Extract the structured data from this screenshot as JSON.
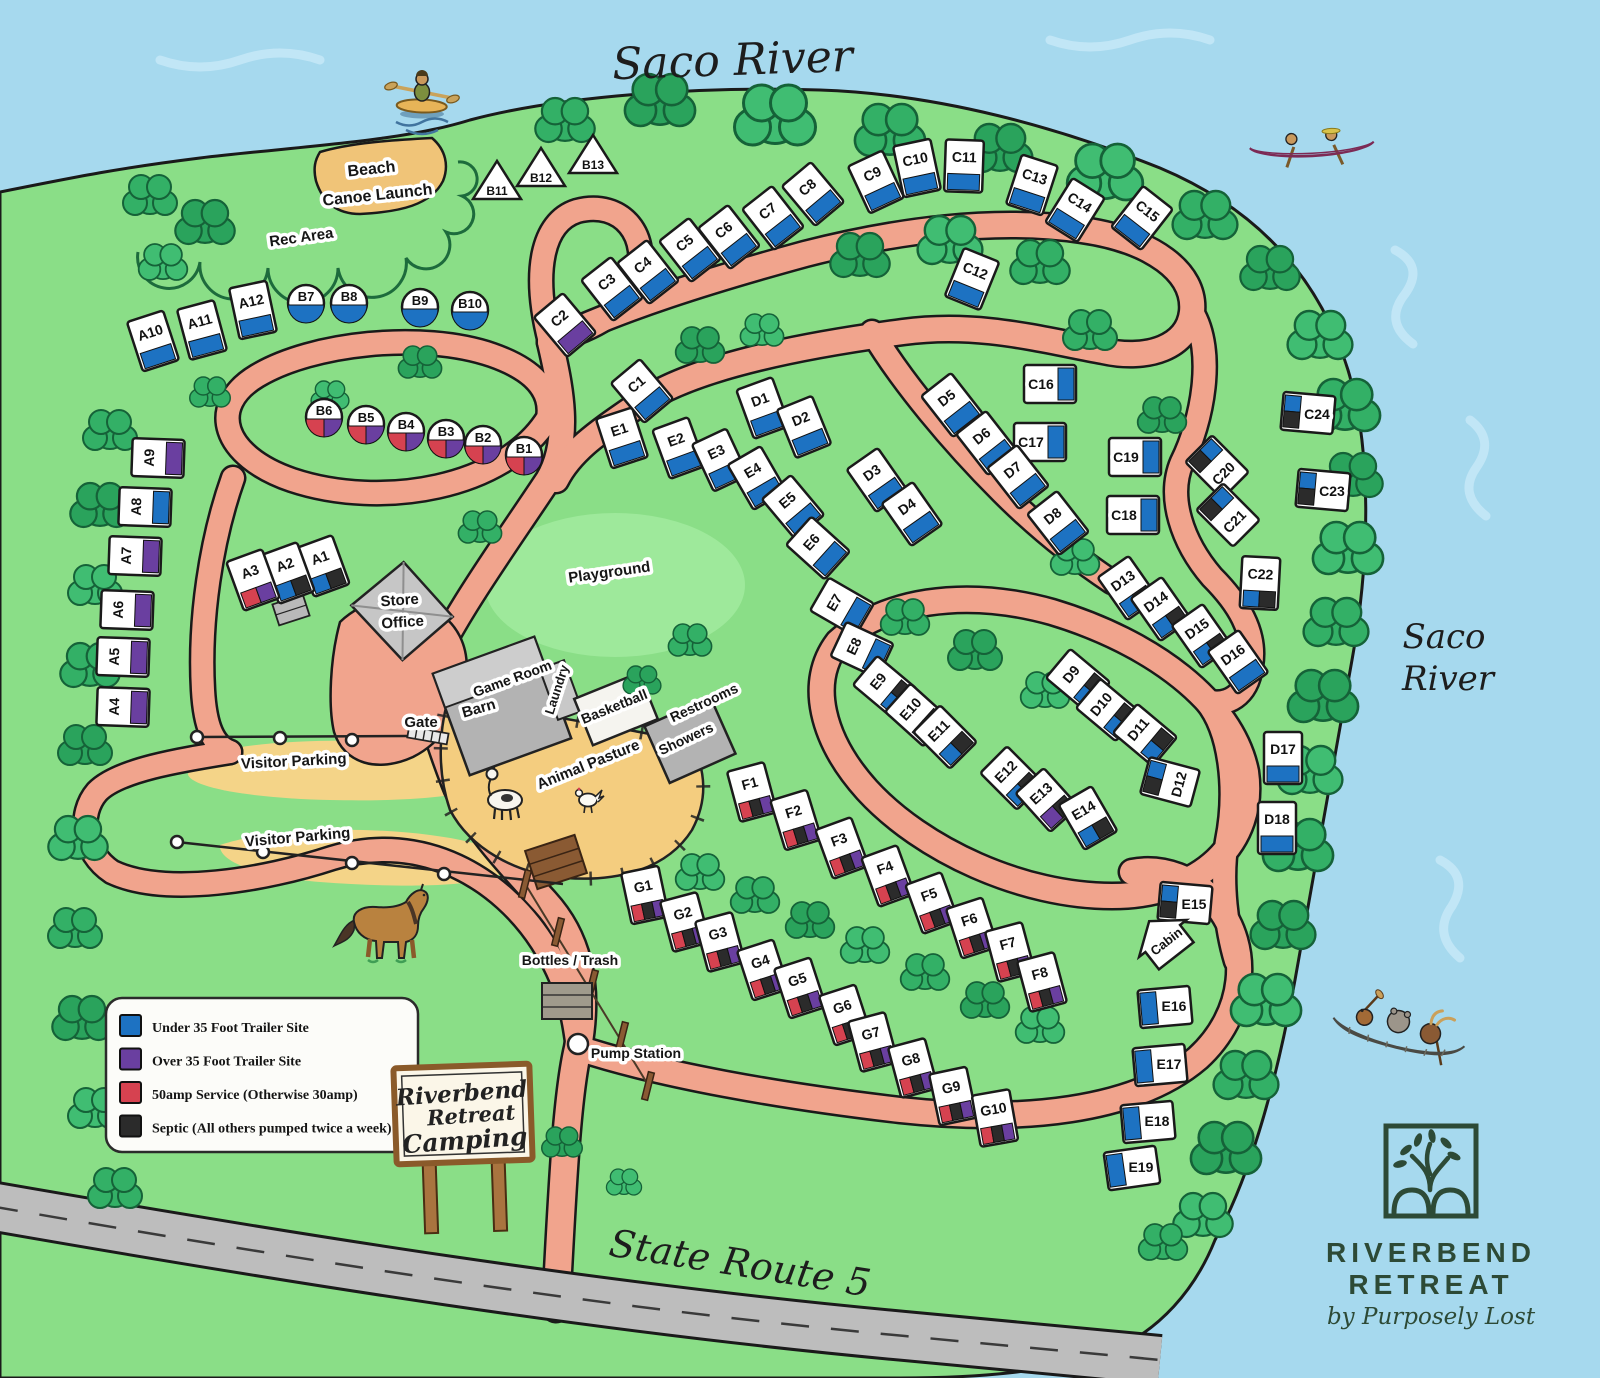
{
  "map_title": "Riverbend Retreat Camping Map",
  "river_label_top": "Saco River",
  "river_label_right_line1": "Saco",
  "river_label_right_line2": "River",
  "road_label": "State Route 5",
  "palette": {
    "water": "#a6d9ee",
    "land": "#8ade87",
    "road": "#f1a48d",
    "sand": "#f4cd7f",
    "tree": "#2fae62",
    "logo_green": "#2d4a36",
    "site_colors": {
      "blue": "#1d72c2",
      "purple": "#6a3fa0",
      "red": "#d64250",
      "black": "#2b2b2b"
    }
  },
  "legend": {
    "items": [
      {
        "color_key": "blue",
        "color": "#1d72c2",
        "label": "Under 35 Foot Trailer Site"
      },
      {
        "color_key": "purple",
        "color": "#6a3fa0",
        "label": "Over 35 Foot Trailer Site"
      },
      {
        "color_key": "red",
        "color": "#d64250",
        "label": "50amp Service (Otherwise 30amp)"
      },
      {
        "color_key": "black",
        "color": "#2b2b2b",
        "label": "Septic (All others pumped twice a week)"
      }
    ]
  },
  "sign": {
    "lines": [
      "Riverbend",
      "Retreat",
      "Camping"
    ]
  },
  "logo": {
    "line1": "RIVERBEND",
    "line2": "RETREAT",
    "tagline": "by Purposely Lost"
  },
  "labels": [
    {
      "text": "Saco River",
      "x": 733,
      "y": 75,
      "rot": -2,
      "size": 44,
      "style": "hand"
    },
    {
      "text": "Saco",
      "x": 1444,
      "y": 648,
      "rot": 0,
      "size": 34,
      "style": "hand"
    },
    {
      "text": "River",
      "x": 1448,
      "y": 690,
      "rot": 0,
      "size": 34,
      "style": "hand"
    },
    {
      "text": "State Route 5",
      "x": 738,
      "y": 1276,
      "rot": 9,
      "size": 38,
      "style": "hand"
    },
    {
      "text": "Beach",
      "x": 372,
      "y": 174,
      "rot": -6,
      "size": 16,
      "style": "chip"
    },
    {
      "text": "Canoe Launch",
      "x": 378,
      "y": 200,
      "rot": -6,
      "size": 16,
      "style": "chip"
    },
    {
      "text": "Rec Area",
      "x": 302,
      "y": 242,
      "rot": -8,
      "size": 15,
      "style": "chip"
    },
    {
      "text": "Playground",
      "x": 610,
      "y": 577,
      "rot": -8,
      "size": 15,
      "style": "chip"
    },
    {
      "text": "Store",
      "x": 400,
      "y": 605,
      "rot": -4,
      "size": 15,
      "style": "chip"
    },
    {
      "text": "Office",
      "x": 403,
      "y": 627,
      "rot": -4,
      "size": 15,
      "style": "chip"
    },
    {
      "text": "Game Room",
      "x": 514,
      "y": 683,
      "rot": -20,
      "size": 14,
      "style": "chip"
    },
    {
      "text": "Barn",
      "x": 480,
      "y": 713,
      "rot": -16,
      "size": 15,
      "style": "chip"
    },
    {
      "text": "Laundry",
      "x": 561,
      "y": 691,
      "rot": -72,
      "size": 13,
      "style": "chip"
    },
    {
      "text": "Basketball",
      "x": 616,
      "y": 711,
      "rot": -22,
      "size": 14,
      "style": "chip"
    },
    {
      "text": "Restrooms",
      "x": 706,
      "y": 707,
      "rot": -25,
      "size": 14,
      "style": "chip"
    },
    {
      "text": "Showers",
      "x": 688,
      "y": 743,
      "rot": -25,
      "size": 14,
      "style": "chip"
    },
    {
      "text": "Animal Pasture",
      "x": 590,
      "y": 769,
      "rot": -22,
      "size": 15,
      "style": "chip"
    },
    {
      "text": "Gate",
      "x": 421,
      "y": 727,
      "rot": 0,
      "size": 15,
      "style": "chip",
      "color": "#41368c"
    },
    {
      "text": "Visitor Parking",
      "x": 294,
      "y": 766,
      "rot": -3,
      "size": 15,
      "style": "chip"
    },
    {
      "text": "Visitor Parking",
      "x": 298,
      "y": 842,
      "rot": -5,
      "size": 15,
      "style": "chip"
    },
    {
      "text": "Bottles / Trash",
      "x": 570,
      "y": 965,
      "rot": 0,
      "size": 14,
      "style": "chip"
    },
    {
      "text": "Pump Station",
      "x": 636,
      "y": 1058,
      "rot": 0,
      "size": 14,
      "style": "chip"
    }
  ],
  "sites": [
    {
      "id": "A1",
      "x": 323,
      "y": 566,
      "rot": -20,
      "kind": "rv",
      "c": [
        "blue",
        "black"
      ]
    },
    {
      "id": "A2",
      "x": 288,
      "y": 573,
      "rot": -20,
      "kind": "rv",
      "c": [
        "blue",
        "black"
      ]
    },
    {
      "id": "A3",
      "x": 253,
      "y": 580,
      "rot": -20,
      "kind": "rv",
      "c": [
        "red",
        "purple"
      ]
    },
    {
      "id": "A4",
      "x": 123,
      "y": 707,
      "rot": -88,
      "kind": "rv",
      "c": [
        "purple"
      ]
    },
    {
      "id": "A5",
      "x": 123,
      "y": 657,
      "rot": -88,
      "kind": "rv",
      "c": [
        "purple"
      ]
    },
    {
      "id": "A6",
      "x": 127,
      "y": 610,
      "rot": -88,
      "kind": "rv",
      "c": [
        "purple"
      ]
    },
    {
      "id": "A7",
      "x": 135,
      "y": 556,
      "rot": -88,
      "kind": "rv",
      "c": [
        "purple"
      ]
    },
    {
      "id": "A8",
      "x": 145,
      "y": 507,
      "rot": -88,
      "kind": "rv",
      "c": [
        "blue"
      ]
    },
    {
      "id": "A9",
      "x": 158,
      "y": 458,
      "rot": -88,
      "kind": "rv",
      "c": [
        "purple"
      ]
    },
    {
      "id": "A10",
      "x": 153,
      "y": 341,
      "rot": -18,
      "kind": "rv",
      "c": [
        "blue"
      ]
    },
    {
      "id": "A11",
      "x": 202,
      "y": 330,
      "rot": -15,
      "kind": "rv",
      "c": [
        "blue"
      ]
    },
    {
      "id": "A12",
      "x": 253,
      "y": 310,
      "rot": -12,
      "kind": "rv",
      "c": [
        "blue"
      ]
    },
    {
      "id": "B1",
      "x": 524,
      "y": 455,
      "kind": "circle",
      "c": [
        "red",
        "purple"
      ]
    },
    {
      "id": "B2",
      "x": 483,
      "y": 444,
      "kind": "circle",
      "c": [
        "red",
        "purple"
      ]
    },
    {
      "id": "B3",
      "x": 446,
      "y": 438,
      "kind": "circle",
      "c": [
        "red",
        "purple"
      ]
    },
    {
      "id": "B4",
      "x": 406,
      "y": 431,
      "kind": "circle",
      "c": [
        "red",
        "purple"
      ]
    },
    {
      "id": "B5",
      "x": 366,
      "y": 424,
      "kind": "circle",
      "c": [
        "red",
        "purple"
      ]
    },
    {
      "id": "B6",
      "x": 324,
      "y": 417,
      "kind": "circle",
      "c": [
        "red",
        "purple"
      ]
    },
    {
      "id": "B7",
      "x": 306,
      "y": 303,
      "kind": "circle",
      "c": [
        "blue"
      ]
    },
    {
      "id": "B8",
      "x": 349,
      "y": 303,
      "kind": "circle",
      "c": [
        "blue"
      ]
    },
    {
      "id": "B9",
      "x": 420,
      "y": 307,
      "kind": "circle",
      "c": [
        "blue"
      ]
    },
    {
      "id": "B10",
      "x": 470,
      "y": 310,
      "kind": "circle",
      "c": [
        "blue"
      ]
    },
    {
      "id": "B11",
      "x": 497,
      "y": 183,
      "kind": "tent"
    },
    {
      "id": "B12",
      "x": 541,
      "y": 170,
      "kind": "tent"
    },
    {
      "id": "B13",
      "x": 593,
      "y": 157,
      "kind": "tent"
    },
    {
      "id": "C1",
      "x": 642,
      "y": 391,
      "rot": -40,
      "kind": "rv",
      "c": [
        "blue"
      ]
    },
    {
      "id": "C2",
      "x": 565,
      "y": 325,
      "rot": -40,
      "kind": "rv",
      "c": [
        "purple"
      ]
    },
    {
      "id": "C3",
      "x": 612,
      "y": 289,
      "rot": -38,
      "kind": "rv",
      "c": [
        "blue"
      ]
    },
    {
      "id": "C4",
      "x": 648,
      "y": 272,
      "rot": -38,
      "kind": "rv",
      "c": [
        "blue"
      ]
    },
    {
      "id": "C5",
      "x": 690,
      "y": 250,
      "rot": -38,
      "kind": "rv",
      "c": [
        "blue"
      ]
    },
    {
      "id": "C6",
      "x": 729,
      "y": 237,
      "rot": -38,
      "kind": "rv",
      "c": [
        "blue"
      ]
    },
    {
      "id": "C7",
      "x": 773,
      "y": 218,
      "rot": -38,
      "kind": "rv",
      "c": [
        "blue"
      ]
    },
    {
      "id": "C8",
      "x": 813,
      "y": 194,
      "rot": -40,
      "kind": "rv",
      "c": [
        "blue"
      ]
    },
    {
      "id": "C9",
      "x": 876,
      "y": 182,
      "rot": -25,
      "kind": "rv",
      "c": [
        "blue"
      ]
    },
    {
      "id": "C10",
      "x": 917,
      "y": 168,
      "rot": -12,
      "kind": "rv",
      "c": [
        "blue"
      ]
    },
    {
      "id": "C11",
      "x": 964,
      "y": 166,
      "rot": 2,
      "kind": "rv",
      "c": [
        "blue"
      ]
    },
    {
      "id": "C12",
      "x": 972,
      "y": 279,
      "rot": 22,
      "kind": "rv",
      "c": [
        "blue"
      ]
    },
    {
      "id": "C13",
      "x": 1032,
      "y": 185,
      "rot": 18,
      "kind": "rv",
      "c": [
        "blue"
      ]
    },
    {
      "id": "C14",
      "x": 1075,
      "y": 210,
      "rot": 32,
      "kind": "rv",
      "c": [
        "blue"
      ]
    },
    {
      "id": "C15",
      "x": 1142,
      "y": 218,
      "rot": 38,
      "kind": "rv",
      "c": [
        "blue"
      ]
    },
    {
      "id": "C16",
      "x": 1050,
      "y": 384,
      "rot": -90,
      "lh": true,
      "kind": "rv",
      "c": [
        "blue"
      ]
    },
    {
      "id": "C17",
      "x": 1040,
      "y": 442,
      "rot": -90,
      "lh": true,
      "kind": "rv",
      "c": [
        "blue"
      ]
    },
    {
      "id": "C18",
      "x": 1133,
      "y": 515,
      "rot": -90,
      "lh": true,
      "kind": "rv",
      "c": [
        "blue"
      ]
    },
    {
      "id": "C19",
      "x": 1135,
      "y": 457,
      "rot": -90,
      "lh": true,
      "kind": "rv",
      "c": [
        "blue"
      ]
    },
    {
      "id": "C20",
      "x": 1217,
      "y": 467,
      "rot": 135,
      "kind": "rv",
      "c": [
        "blue",
        "black"
      ]
    },
    {
      "id": "C21",
      "x": 1228,
      "y": 515,
      "rot": 135,
      "kind": "rv",
      "c": [
        "blue",
        "black"
      ]
    },
    {
      "id": "C22",
      "x": 1260,
      "y": 583,
      "rot": 3,
      "kind": "rv",
      "c": [
        "blue",
        "black"
      ]
    },
    {
      "id": "C23",
      "x": 1323,
      "y": 490,
      "rot": 95,
      "lh": true,
      "kind": "rv",
      "c": [
        "blue",
        "black"
      ]
    },
    {
      "id": "C24",
      "x": 1308,
      "y": 413,
      "rot": 95,
      "lh": true,
      "kind": "rv",
      "c": [
        "blue",
        "black"
      ]
    },
    {
      "id": "D1",
      "x": 763,
      "y": 408,
      "rot": -20,
      "kind": "rv",
      "c": [
        "blue"
      ]
    },
    {
      "id": "D2",
      "x": 804,
      "y": 427,
      "rot": -22,
      "kind": "rv",
      "c": [
        "blue"
      ]
    },
    {
      "id": "D3",
      "x": 877,
      "y": 480,
      "rot": -35,
      "kind": "rv",
      "c": [
        "blue"
      ]
    },
    {
      "id": "D4",
      "x": 912,
      "y": 514,
      "rot": -35,
      "kind": "rv",
      "c": [
        "blue"
      ]
    },
    {
      "id": "D5",
      "x": 952,
      "y": 405,
      "rot": -38,
      "kind": "rv",
      "c": [
        "blue"
      ]
    },
    {
      "id": "D6",
      "x": 987,
      "y": 443,
      "rot": -38,
      "kind": "rv",
      "c": [
        "blue"
      ]
    },
    {
      "id": "D7",
      "x": 1018,
      "y": 477,
      "rot": -38,
      "kind": "rv",
      "c": [
        "blue"
      ]
    },
    {
      "id": "D8",
      "x": 1058,
      "y": 523,
      "rot": -38,
      "kind": "rv",
      "c": [
        "blue"
      ]
    },
    {
      "id": "D9",
      "x": 1078,
      "y": 680,
      "rot": -50,
      "kind": "rv",
      "c": [
        "blue",
        "black"
      ]
    },
    {
      "id": "D10",
      "x": 1108,
      "y": 710,
      "rot": -50,
      "kind": "rv",
      "c": [
        "blue",
        "black"
      ]
    },
    {
      "id": "D11",
      "x": 1145,
      "y": 735,
      "rot": -50,
      "kind": "rv",
      "c": [
        "blue",
        "black"
      ]
    },
    {
      "id": "D12",
      "x": 1170,
      "y": 782,
      "rot": 105,
      "kind": "rv",
      "c": [
        "blue",
        "black"
      ]
    },
    {
      "id": "D13",
      "x": 1128,
      "y": 588,
      "rot": -35,
      "kind": "rv",
      "c": [
        "blue",
        "black"
      ]
    },
    {
      "id": "D14",
      "x": 1161,
      "y": 609,
      "rot": -35,
      "kind": "rv",
      "c": [
        "blue",
        "black"
      ]
    },
    {
      "id": "D15",
      "x": 1202,
      "y": 636,
      "rot": -35,
      "kind": "rv",
      "c": [
        "blue",
        "black"
      ]
    },
    {
      "id": "D16",
      "x": 1238,
      "y": 662,
      "rot": -35,
      "kind": "rv",
      "c": [
        "blue"
      ]
    },
    {
      "id": "D17",
      "x": 1283,
      "y": 758,
      "rot": 0,
      "kind": "rv",
      "c": [
        "blue"
      ]
    },
    {
      "id": "D18",
      "x": 1277,
      "y": 828,
      "rot": 0,
      "kind": "rv",
      "c": [
        "blue"
      ]
    },
    {
      "id": "E1",
      "x": 622,
      "y": 438,
      "rot": -18,
      "kind": "rv",
      "c": [
        "blue"
      ]
    },
    {
      "id": "E2",
      "x": 679,
      "y": 448,
      "rot": -20,
      "kind": "rv",
      "c": [
        "blue"
      ]
    },
    {
      "id": "E3",
      "x": 720,
      "y": 460,
      "rot": -25,
      "kind": "rv",
      "c": [
        "blue"
      ]
    },
    {
      "id": "E4",
      "x": 757,
      "y": 478,
      "rot": -30,
      "kind": "rv",
      "c": [
        "blue"
      ]
    },
    {
      "id": "E5",
      "x": 793,
      "y": 507,
      "rot": -40,
      "kind": "rv",
      "c": [
        "blue"
      ]
    },
    {
      "id": "E6",
      "x": 818,
      "y": 548,
      "rot": -48,
      "kind": "rv",
      "c": [
        "blue"
      ]
    },
    {
      "id": "E7",
      "x": 842,
      "y": 607,
      "rot": -60,
      "kind": "rv",
      "c": [
        "blue"
      ]
    },
    {
      "id": "E8",
      "x": 862,
      "y": 650,
      "rot": -65,
      "kind": "rv",
      "c": [
        "blue"
      ]
    },
    {
      "id": "E9",
      "x": 885,
      "y": 687,
      "rot": -50,
      "kind": "rv",
      "c": [
        "blue",
        "black"
      ]
    },
    {
      "id": "E10",
      "x": 917,
      "y": 715,
      "rot": -48,
      "kind": "rv",
      "c": [
        "blue",
        "black"
      ]
    },
    {
      "id": "E11",
      "x": 945,
      "y": 737,
      "rot": -45,
      "kind": "rv",
      "c": [
        "blue",
        "black"
      ]
    },
    {
      "id": "E12",
      "x": 1012,
      "y": 778,
      "rot": -45,
      "kind": "rv",
      "c": [
        "blue",
        "black"
      ]
    },
    {
      "id": "E13",
      "x": 1047,
      "y": 800,
      "rot": -42,
      "kind": "rv",
      "c": [
        "purple",
        "black"
      ]
    },
    {
      "id": "E14",
      "x": 1088,
      "y": 818,
      "rot": -30,
      "kind": "rv",
      "c": [
        "blue",
        "black"
      ]
    },
    {
      "id": "E15",
      "x": 1185,
      "y": 903,
      "rot": 95,
      "lh": true,
      "kind": "rv",
      "c": [
        "blue",
        "black"
      ]
    },
    {
      "id": "E16",
      "x": 1165,
      "y": 1007,
      "rot": 85,
      "lh": true,
      "kind": "rv",
      "c": [
        "blue"
      ]
    },
    {
      "id": "E17",
      "x": 1160,
      "y": 1065,
      "rot": 85,
      "lh": true,
      "kind": "rv",
      "c": [
        "blue"
      ]
    },
    {
      "id": "E18",
      "x": 1148,
      "y": 1122,
      "rot": 85,
      "lh": true,
      "kind": "rv",
      "c": [
        "blue"
      ]
    },
    {
      "id": "E19",
      "x": 1132,
      "y": 1168,
      "rot": 82,
      "lh": true,
      "kind": "rv",
      "c": [
        "blue"
      ]
    },
    {
      "id": "F1",
      "x": 752,
      "y": 792,
      "rot": -15,
      "kind": "rv",
      "c": [
        "red",
        "black",
        "purple"
      ]
    },
    {
      "id": "F2",
      "x": 796,
      "y": 820,
      "rot": -17,
      "kind": "rv",
      "c": [
        "red",
        "black",
        "purple"
      ]
    },
    {
      "id": "F3",
      "x": 842,
      "y": 848,
      "rot": -20,
      "kind": "rv",
      "c": [
        "red",
        "black",
        "purple"
      ]
    },
    {
      "id": "F4",
      "x": 888,
      "y": 876,
      "rot": -20,
      "kind": "rv",
      "c": [
        "red",
        "black",
        "purple"
      ]
    },
    {
      "id": "F5",
      "x": 932,
      "y": 903,
      "rot": -20,
      "kind": "rv",
      "c": [
        "red",
        "black",
        "purple"
      ]
    },
    {
      "id": "F6",
      "x": 972,
      "y": 928,
      "rot": -18,
      "kind": "rv",
      "c": [
        "red",
        "black",
        "purple"
      ]
    },
    {
      "id": "F7",
      "x": 1010,
      "y": 952,
      "rot": -15,
      "kind": "rv",
      "c": [
        "red",
        "black",
        "purple"
      ]
    },
    {
      "id": "F8",
      "x": 1042,
      "y": 982,
      "rot": -15,
      "kind": "rv",
      "c": [
        "red",
        "black",
        "purple"
      ]
    },
    {
      "id": "G1",
      "x": 645,
      "y": 895,
      "rot": -12,
      "kind": "rv",
      "c": [
        "red",
        "black",
        "purple"
      ]
    },
    {
      "id": "G2",
      "x": 685,
      "y": 922,
      "rot": -15,
      "kind": "rv",
      "c": [
        "red",
        "black",
        "purple"
      ]
    },
    {
      "id": "G3",
      "x": 720,
      "y": 942,
      "rot": -15,
      "kind": "rv",
      "c": [
        "red",
        "black",
        "purple"
      ]
    },
    {
      "id": "G4",
      "x": 763,
      "y": 970,
      "rot": -18,
      "kind": "rv",
      "c": [
        "red",
        "black",
        "purple"
      ]
    },
    {
      "id": "G5",
      "x": 800,
      "y": 988,
      "rot": -18,
      "kind": "rv",
      "c": [
        "red",
        "black",
        "purple"
      ]
    },
    {
      "id": "G6",
      "x": 845,
      "y": 1015,
      "rot": -18,
      "kind": "rv",
      "c": [
        "red",
        "black",
        "purple"
      ]
    },
    {
      "id": "G7",
      "x": 873,
      "y": 1042,
      "rot": -15,
      "kind": "rv",
      "c": [
        "red",
        "black",
        "purple"
      ]
    },
    {
      "id": "G8",
      "x": 913,
      "y": 1068,
      "rot": -15,
      "kind": "rv",
      "c": [
        "red",
        "black",
        "purple"
      ]
    },
    {
      "id": "G9",
      "x": 953,
      "y": 1096,
      "rot": -12,
      "kind": "rv",
      "c": [
        "red",
        "black",
        "purple"
      ]
    },
    {
      "id": "G10",
      "x": 995,
      "y": 1118,
      "rot": -10,
      "kind": "rv",
      "c": [
        "red",
        "black",
        "purple"
      ]
    },
    {
      "id": "Cabin",
      "x": 1168,
      "y": 942,
      "rot": -38,
      "kind": "cabin"
    }
  ]
}
